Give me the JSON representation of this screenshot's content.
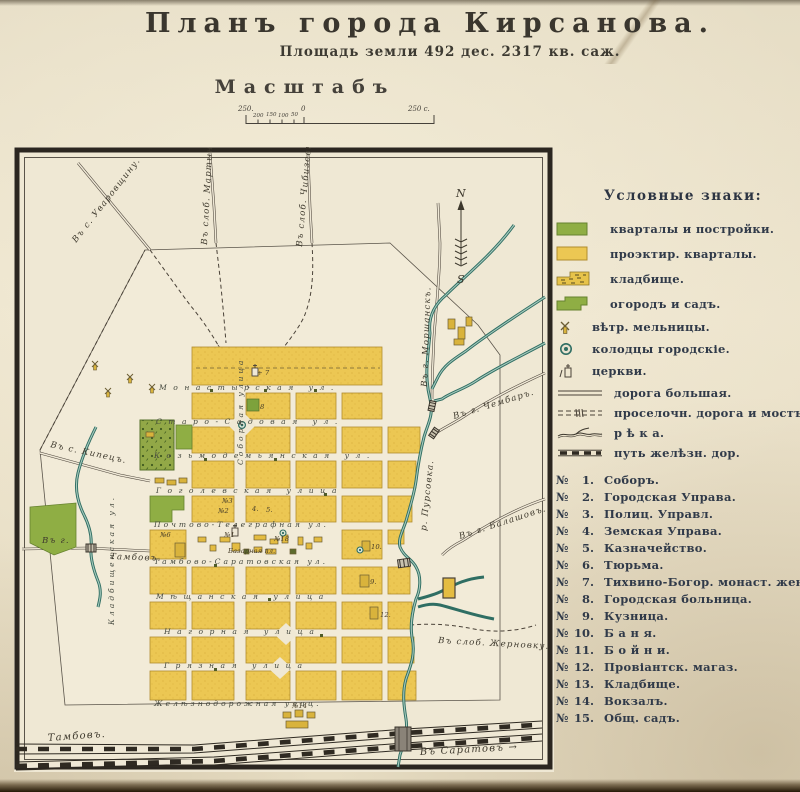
{
  "header": {
    "title": "Планъ города Кирсанова.",
    "subtitle": "Площадь земли 492 дес. 2317 кв. саж.",
    "scale_heading": "Масштабъ",
    "scale": {
      "far_left": "250.",
      "t200": "200",
      "t150": "150",
      "t100": "100",
      "t50": "50",
      "zero": "0",
      "far_right": "250 с."
    }
  },
  "compass": {
    "n": "N",
    "s": "S"
  },
  "legend": {
    "heading": "Условные знаки:",
    "num_sign": "№",
    "swatch_items": [
      {
        "label": "кварталы и постройки."
      },
      {
        "label": "проэктир. кварталы."
      },
      {
        "label": "кладбище."
      },
      {
        "label": "огородъ и садъ."
      },
      {
        "label": "вѣтр. мельницы."
      },
      {
        "label": "колодцы городскіе."
      },
      {
        "label": "церкви."
      }
    ],
    "line_items": [
      {
        "label": "дорога большая."
      },
      {
        "label": "проселочн. дорога и мостъ."
      },
      {
        "label": "р ѣ к а."
      },
      {
        "label": "путь желѣзн. дор."
      }
    ],
    "numbered_items": [
      {
        "n": "1.",
        "label": "Соборъ."
      },
      {
        "n": "2.",
        "label": "Городская Управа."
      },
      {
        "n": "3.",
        "label": "Полиц. Управл."
      },
      {
        "n": "4.",
        "label": "Земская Управа."
      },
      {
        "n": "5.",
        "label": "Казначейство."
      },
      {
        "n": "6.",
        "label": "Тюрьма."
      },
      {
        "n": "7.",
        "label": "Тихвино-Богор. монаст. женск."
      },
      {
        "n": "8.",
        "label": "Городская больница."
      },
      {
        "n": "9.",
        "label": "Кузница."
      },
      {
        "n": "10.",
        "label": "Б а н я."
      },
      {
        "n": "11.",
        "label": "Б о й н и."
      },
      {
        "n": "12.",
        "label": "Провіантск. магаз."
      },
      {
        "n": "13.",
        "label": "Кладбище."
      },
      {
        "n": "14.",
        "label": "Вокзалъ."
      },
      {
        "n": "15.",
        "label": "Общ. садъ."
      }
    ]
  },
  "map": {
    "river_label": "р. Пурсовка.",
    "roads": {
      "uvarovshchina": "Въ с. Уваровщину.",
      "martynovka": "Въ слоб. Мартыновку.",
      "chibizovka": "Въ слоб. Чибизовку.",
      "morshansk": "Въ г. Моршанскъ.",
      "chembar": "Въ г. Чембаръ.",
      "balashov": "Въ г. Балашовъ.",
      "zhernovka": "Въ слоб. Жерновку.",
      "kipets": "Въ с. Кипецъ.",
      "tambov_pre": "Въ г.",
      "tambov_post": "Тамбовъ.",
      "rail_tambov": "Тамбовъ.",
      "rail_saratov": "Въ Саратовъ →"
    },
    "streets": {
      "monastyrskaya": "Монастырская ул.",
      "starosadovaya": "Старо-Садовая ул.",
      "kozmodemyanskaya": "Козьмодемьянская ул.",
      "gogolevskaya": "Гоголевская улица",
      "pochtovo": "Почтово-Телеграфная ул.",
      "tambovo_saratovskaya": "Тамбово-Саратовская ул.",
      "meshchanskaya": "Мѣщанская улица",
      "nagornaya": "Нагорная улица",
      "gryaznaya": "Грязная улица",
      "zheleznodorozhnaya": "Желѣзнодорожная улиц.",
      "sobornaya": "Соборная улица",
      "kladbishchenskaya": "Кладбищенская ул."
    },
    "markers": {
      "m7": "+ 7",
      "m8": "8",
      "m3": "№3",
      "m2": "№2",
      "m4": "4.",
      "m5": "5.",
      "m1": "№1",
      "m18": "№18",
      "m6": "№6",
      "m10": "10.",
      "m9": "9.",
      "m12": "12.",
      "m14": "№14",
      "bazaar": "Базарная пл."
    }
  }
}
